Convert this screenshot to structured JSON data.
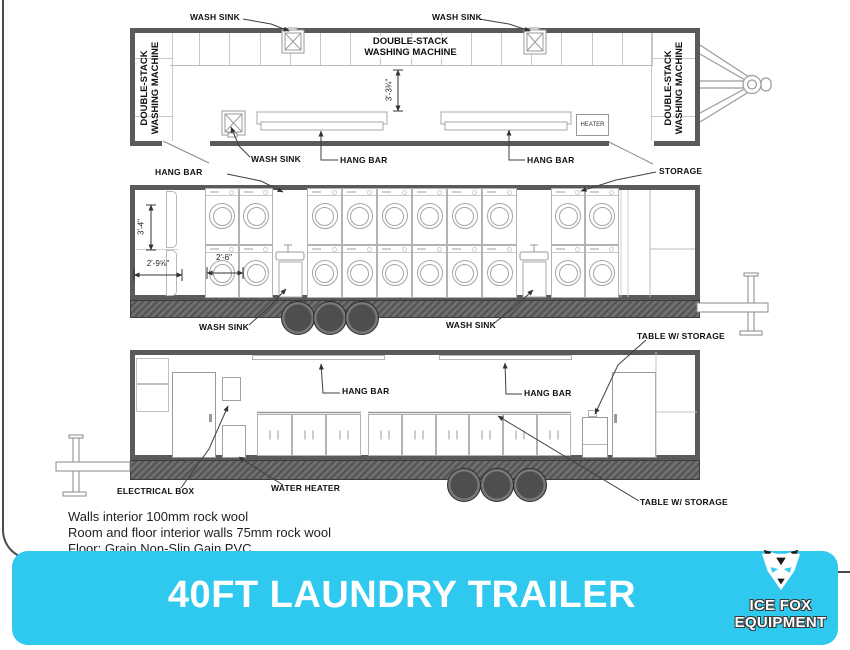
{
  "colors": {
    "accent_cyan": "#2FC9EF",
    "wall_gray": "#5a5a5a",
    "wheel_gray": "#4e4e4e"
  },
  "banner": {
    "title": "40FT LAUNDRY TRAILER",
    "logo_line1": "ICE FOX",
    "logo_line2": "EQUIPMENT"
  },
  "notes": [
    "Walls interior 100mm rock wool",
    "Room and floor interior walls 75mm rock wool",
    "Floor: Grain Non-Slip Gain PVC"
  ],
  "plan": {
    "label_wash_sink_top_left": "WASH SINK",
    "label_wash_sink_top_right": "WASH SINK",
    "label_wash_sink_bottom": "WASH SINK",
    "label_hang_bar_left": "HANG BAR",
    "label_hang_bar_right": "HANG BAR",
    "label_heater": "HEATER",
    "label_left_unit": "DOUBLE-STACK WASHING MACHINE",
    "label_right_unit": "DOUBLE-STACK WASHING MACHINE",
    "label_center_unit": "DOUBLE-STACK WASHING MACHINE",
    "dim_aisle": "3'-3¾\"",
    "machine_cells": 16
  },
  "front": {
    "label_hang_bar": "HANG BAR",
    "label_storage": "STORAGE",
    "label_wash_sink_left": "WASH SINK",
    "label_wash_sink_center": "WASH SINK",
    "label_table_storage": "TABLE W/ STORAGE",
    "dim_height": "3'-4\"",
    "dim_depth": "2'-9⅝\"",
    "dim_machine_width": "2'-6\"",
    "machine_banks": [
      2,
      6,
      2
    ]
  },
  "rear": {
    "label_hang_bar_left": "HANG BAR",
    "label_hang_bar_center": "HANG BAR",
    "label_electrical_box": "ELECTRICAL BOX",
    "label_water_heater": "WATER HEATER",
    "label_table_storage": "TABLE W/ STORAGE",
    "cabinet_doors": [
      3,
      6
    ]
  }
}
